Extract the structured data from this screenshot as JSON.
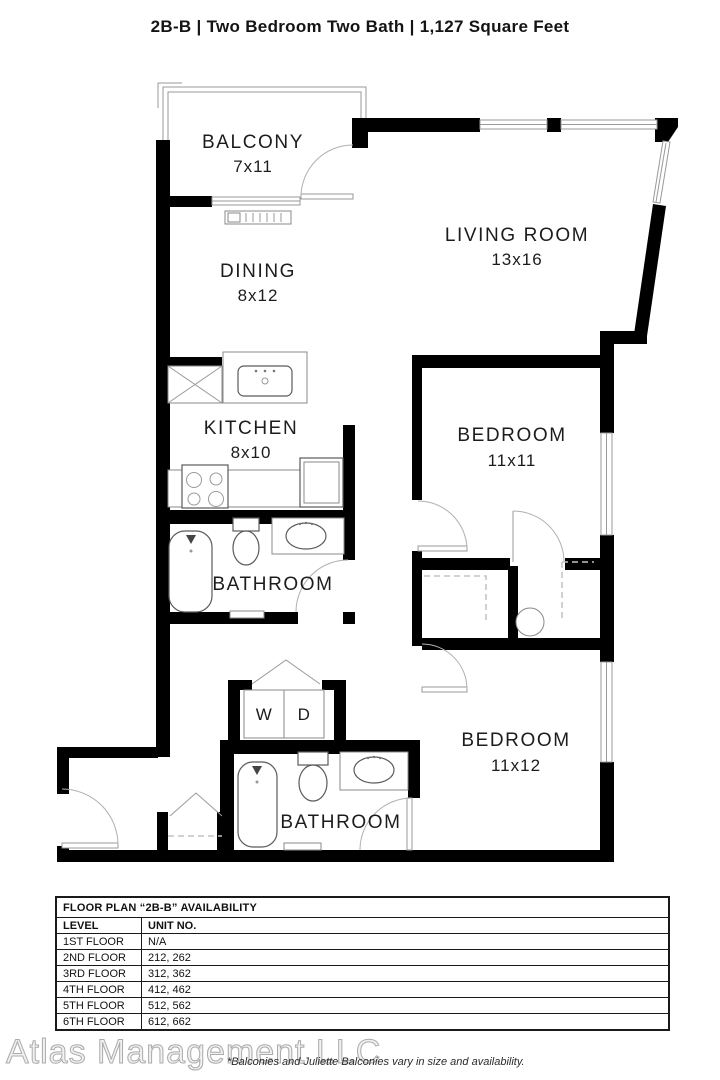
{
  "header": {
    "title": "2B-B | Two Bedroom Two Bath | 1,127 Square Feet"
  },
  "floorplan": {
    "rooms": [
      {
        "name": "BALCONY",
        "dims": "7x11"
      },
      {
        "name": "LIVING ROOM",
        "dims": "13x16"
      },
      {
        "name": "DINING",
        "dims": "8x12"
      },
      {
        "name": "KITCHEN",
        "dims": "8x10"
      },
      {
        "name": "BATHROOM",
        "dims": ""
      },
      {
        "name": "BEDROOM",
        "dims": "11x11"
      },
      {
        "name": "BATHROOM",
        "dims": ""
      },
      {
        "name": "BEDROOM",
        "dims": "11x12"
      }
    ],
    "washer_label": "W",
    "dryer_label": "D"
  },
  "availability_table": {
    "title": "FLOOR PLAN “2B-B” AVAILABILITY",
    "columns": [
      "LEVEL",
      "UNIT NO."
    ],
    "rows": [
      [
        "1ST FLOOR",
        "N/A"
      ],
      [
        "2ND FLOOR",
        "212, 262"
      ],
      [
        "3RD FLOOR",
        "312, 362"
      ],
      [
        "4TH FLOOR",
        "412, 462"
      ],
      [
        "5TH FLOOR",
        "512, 562"
      ],
      [
        "6TH FLOOR",
        "612, 662"
      ]
    ]
  },
  "footer": {
    "watermark": "Atlas Management LLC",
    "disclaimer": "*Balconies and Juliette Balconies vary in size and availability."
  },
  "colors": {
    "wall": "#000000",
    "thin_line": "#9a9a9a",
    "text": "#1c1c1c"
  }
}
